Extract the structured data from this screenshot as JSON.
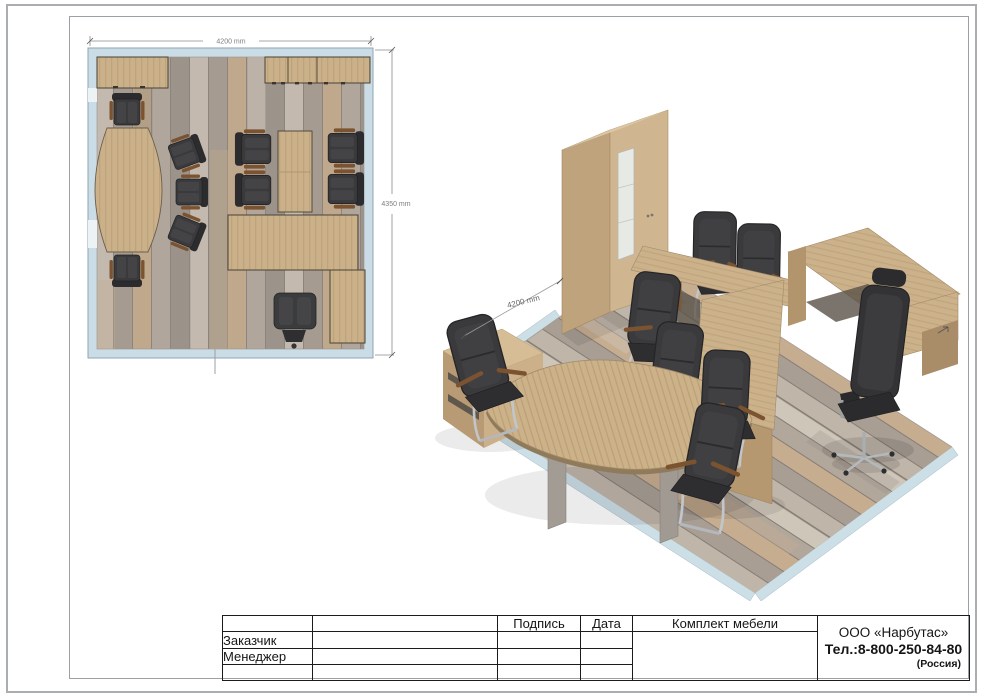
{
  "floor_plan": {
    "width_dim": "4200 mm",
    "height_dim": "4350 mm"
  },
  "iso_view": {
    "depth_dim": "4200 mm"
  },
  "title_block": {
    "col_signature": "Подпись",
    "col_date": "Дата",
    "col_set": "Комплект мебели",
    "row_customer": "Заказчик",
    "row_manager": "Менеджер",
    "company_name": "ООО «Нарбутас»",
    "company_phone": "Тел.:8-800-250-84-80",
    "company_country": "(Россия)"
  },
  "colors": {
    "wood": "#cbb189",
    "wood_dark": "#ab8f6b",
    "wall_blue": "#cadce5",
    "chair_dark": "#39393b",
    "chrome": "#bfc3c7",
    "floor_base": "#b3a99e",
    "armrest_brown": "#7c5330"
  }
}
